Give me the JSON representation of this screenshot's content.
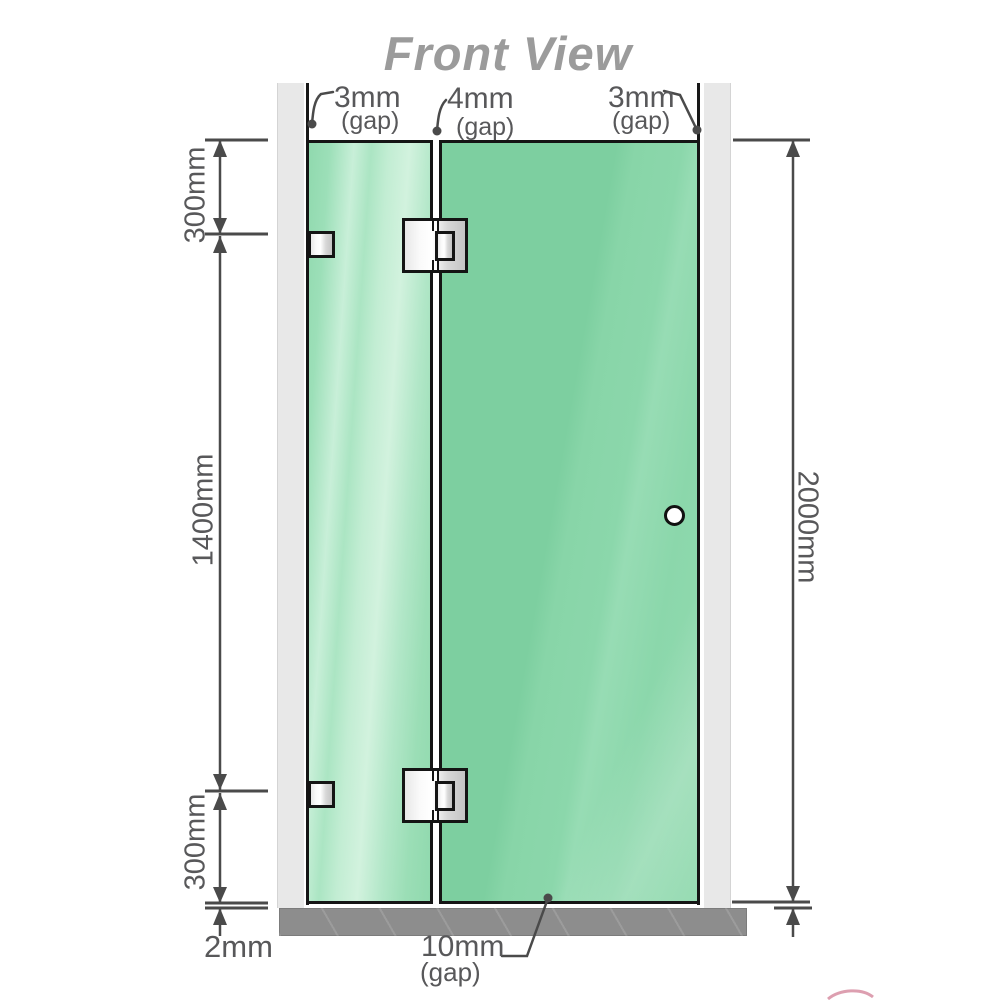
{
  "title": "Front View",
  "labels": {
    "top_gaps": [
      {
        "value": "3mm",
        "qual": "(gap)"
      },
      {
        "value": "4mm",
        "qual": "(gap)"
      },
      {
        "value": "3mm",
        "qual": "(gap)"
      }
    ],
    "left_heights": {
      "top": "300mm",
      "middle": "1400mm",
      "bottom": "300mm"
    },
    "total_height": "2000mm",
    "floor_step": "2mm",
    "bottom_gap": {
      "value": "10mm",
      "qual": "(gap)"
    }
  },
  "colors": {
    "glass_door": "#7dcfa0",
    "glass_panel_light": "#c8efd8",
    "wall": "#e8e8e8",
    "floor": "#8d8d8d",
    "outline": "#151515",
    "dimension_line": "#4a4a4a",
    "dimension_text": "#58585a",
    "title_text": "#9b9b9b",
    "hardware": "#e8e8e8"
  }
}
